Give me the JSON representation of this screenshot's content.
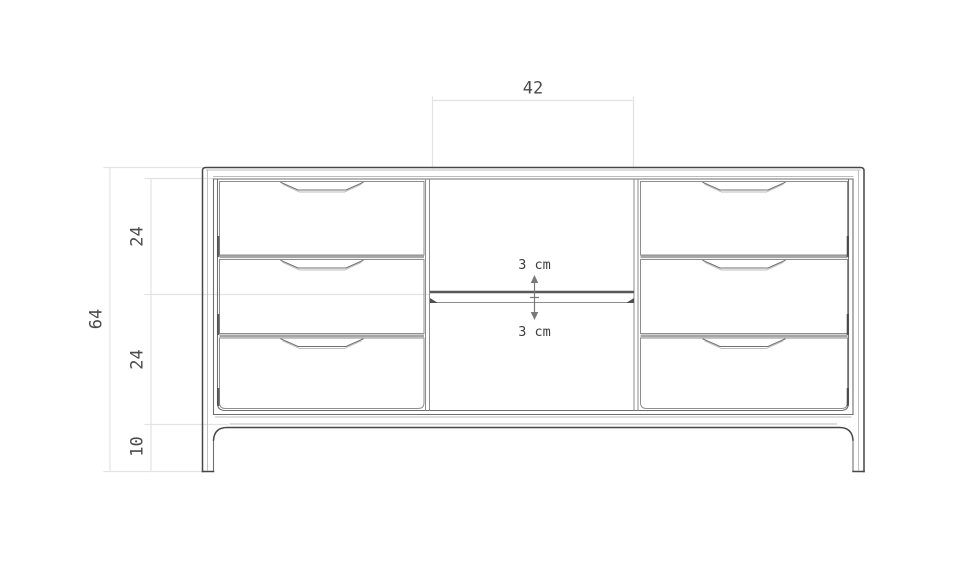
{
  "drawing": {
    "dimension_labels": {
      "middle_section_width": "42",
      "total_height": "64",
      "upper_section_height": "24",
      "lower_section_height": "24",
      "leg_height": "10"
    },
    "shelf_annotation": {
      "above_label": "3 cm",
      "below_label": "3 cm"
    },
    "colors": {
      "background": "#ffffff",
      "outline_dark": "#474747",
      "outline_medium": "#6f6f6f",
      "outline_light": "#8d8d8d",
      "panel_gap": "#a6a6a6",
      "dimension_line": "#e3e3e3",
      "dimension_text": "#4a4a4a",
      "annotation": "#7a7a7a"
    }
  }
}
